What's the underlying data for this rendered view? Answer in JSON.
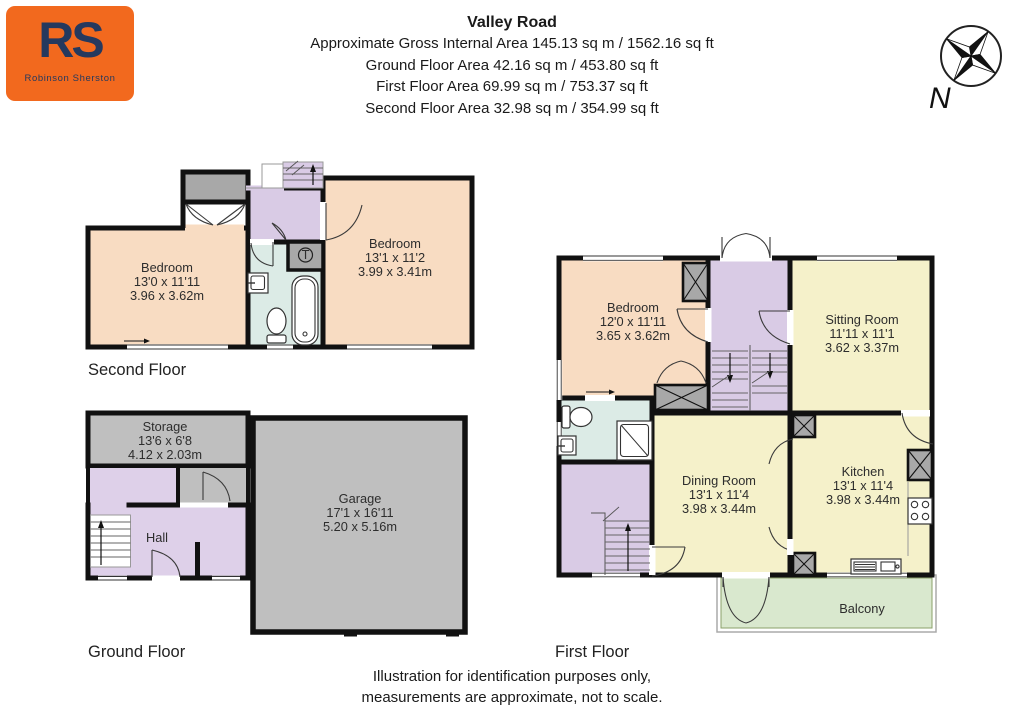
{
  "header": {
    "title": "Valley Road",
    "lines": [
      "Approximate Gross Internal Area 145.13 sq m / 1562.16 sq ft",
      "Ground Floor Area 42.16 sq m / 453.80 sq ft",
      "First Floor Area 69.99 sq m / 753.37 sq ft",
      "Second Floor Area 32.98 sq m / 354.99 sq ft"
    ]
  },
  "logo": {
    "monogram": "RS",
    "name": "Robinson Sherston"
  },
  "compass": {
    "north": "N"
  },
  "floors": {
    "second": {
      "label": "Second Floor",
      "tank": "T",
      "rooms": [
        {
          "name": "Bedroom",
          "imperial": "13'0 x 11'11",
          "metric": "3.96 x 3.62m"
        },
        {
          "name": "Bedroom",
          "imperial": "13'1 x 11'2",
          "metric": "3.99 x 3.41m"
        }
      ]
    },
    "ground": {
      "label": "Ground Floor",
      "rooms": [
        {
          "name": "Storage",
          "imperial": "13'6 x 6'8",
          "metric": "4.12 x 2.03m"
        },
        {
          "name": "Hall",
          "imperial": "",
          "metric": ""
        },
        {
          "name": "Garage",
          "imperial": "17'1 x 16'11",
          "metric": "5.20 x 5.16m"
        }
      ]
    },
    "first": {
      "label": "First Floor",
      "rooms": [
        {
          "name": "Bedroom",
          "imperial": "12'0 x 11'11",
          "metric": "3.65 x 3.62m"
        },
        {
          "name": "Sitting Room",
          "imperial": "11'11 x 11'1",
          "metric": "3.62 x 3.37m"
        },
        {
          "name": "Dining Room",
          "imperial": "13'1 x 11'4",
          "metric": "3.98 x 3.44m"
        },
        {
          "name": "Kitchen",
          "imperial": "13'1 x 11'4",
          "metric": "3.98 x 3.44m"
        },
        {
          "name": "Balcony",
          "imperial": "",
          "metric": ""
        }
      ]
    }
  },
  "footer": {
    "lines": [
      "Illustration for identification purposes only,",
      "measurements are approximate, not to scale."
    ]
  },
  "colors": {
    "wall": "#111111",
    "bedroom": "#f8dcc2",
    "living": "#f5f1ca",
    "landing": "#d9cbe5",
    "bathroom": "#dcebe6",
    "balcony": "#d9e8ce",
    "garage": "#bfbfbf",
    "closet": "#a8a8a8",
    "logo_bg": "#f2691e",
    "logo_text": "#25395e"
  }
}
